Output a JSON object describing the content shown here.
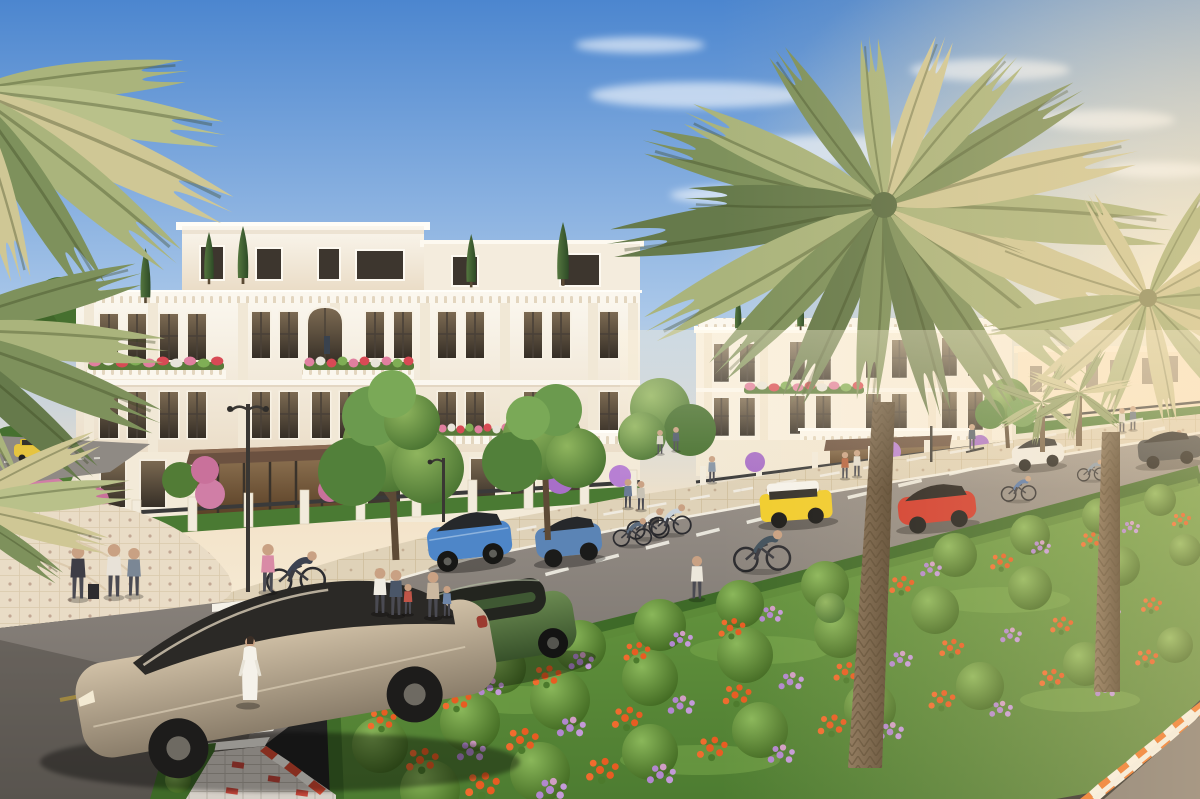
{
  "scene": {
    "description": "Sunlit 3D architectural rendering of a luxury villa boulevard: white neoclassical villas with flower-filled balconies line a palm-shaded avenue with cars, cyclists, pedestrians, a zebra crosswalk and a landscaped flower median."
  },
  "sky": {
    "top": "#4c86cf",
    "mid": "#a9c7e9",
    "horizon": "#f3e3c9",
    "sun_glow": "#fff3d6",
    "cloud": "#ffffff"
  },
  "palette": {
    "road_far": "#9e968e",
    "road_near": "#6b6661",
    "sidewalk": "#dfd2b8",
    "plaza": "#e9dcc6",
    "side_street": "#8f8a84"
  },
  "road": {
    "crosswalk_stripe": "#f4f1e8",
    "lane_dash_white": "#f2efe6",
    "center_dash_yellow": "#d8b64a",
    "curb_stripe_orange": "#ee7122",
    "curb_stripe_white": "#f8f4ea",
    "brick_path": "#d3cdc5",
    "brick_red": "#c5463a"
  },
  "architecture": {
    "facade_white": "#faf6ed",
    "facade_shade": "#eadcc6",
    "facade_warm": "#f6e7cc",
    "window_frame": "#4a4138",
    "glass_dark": "#3a332b",
    "glass_warm": "#8a6f4f",
    "awning": "#6b5140",
    "pillar": "#f2ebdc",
    "iron_fence": "#3a3a3a",
    "balustrade": "#fbf7ee"
  },
  "landscape": {
    "grass": "#4d7c31",
    "grass_light": "#6f9f44",
    "hedge": "#4a7a33",
    "bush": "#639140",
    "bush_light": "#8ab75a",
    "tree": "#5e8c46",
    "tree_dark": "#46702f",
    "cypress": "#3f5f37",
    "palm_green": "#7e915c",
    "palm_light": "#aab47c",
    "palm_gold": "#cfc795",
    "palm_dark": "#667a4b",
    "trunk": "#74604a",
    "trunk_dark": "#53422d",
    "flower_orange": "#e85c22",
    "flower_purple": "#b287cf",
    "flower_pink": "#e07f9f",
    "flower_red": "#d84a55",
    "bougainvillea": "#c9719b"
  },
  "vehicles": [
    {
      "name": "champagne-suv-foreground",
      "color": "#b4a28b"
    },
    {
      "name": "green-suv",
      "color": "#4d6b3d"
    },
    {
      "name": "blue-suv-parked",
      "color": "#4e86c8"
    },
    {
      "name": "blue-car-parked-2",
      "color": "#5b84b5"
    },
    {
      "name": "yellow-mini-suv",
      "color": "#f1cd2e",
      "roof": "#f6f3ec"
    },
    {
      "name": "red-crossover",
      "color": "#d13a2c"
    },
    {
      "name": "white-crossover",
      "color": "#efece5"
    },
    {
      "name": "dark-suv",
      "color": "#3c3f42"
    },
    {
      "name": "yellow-car-side-street",
      "color": "#e6c43f"
    }
  ],
  "people": {
    "skin": "#c9a183",
    "woman_in_white_dress": "#f5f2ea"
  }
}
